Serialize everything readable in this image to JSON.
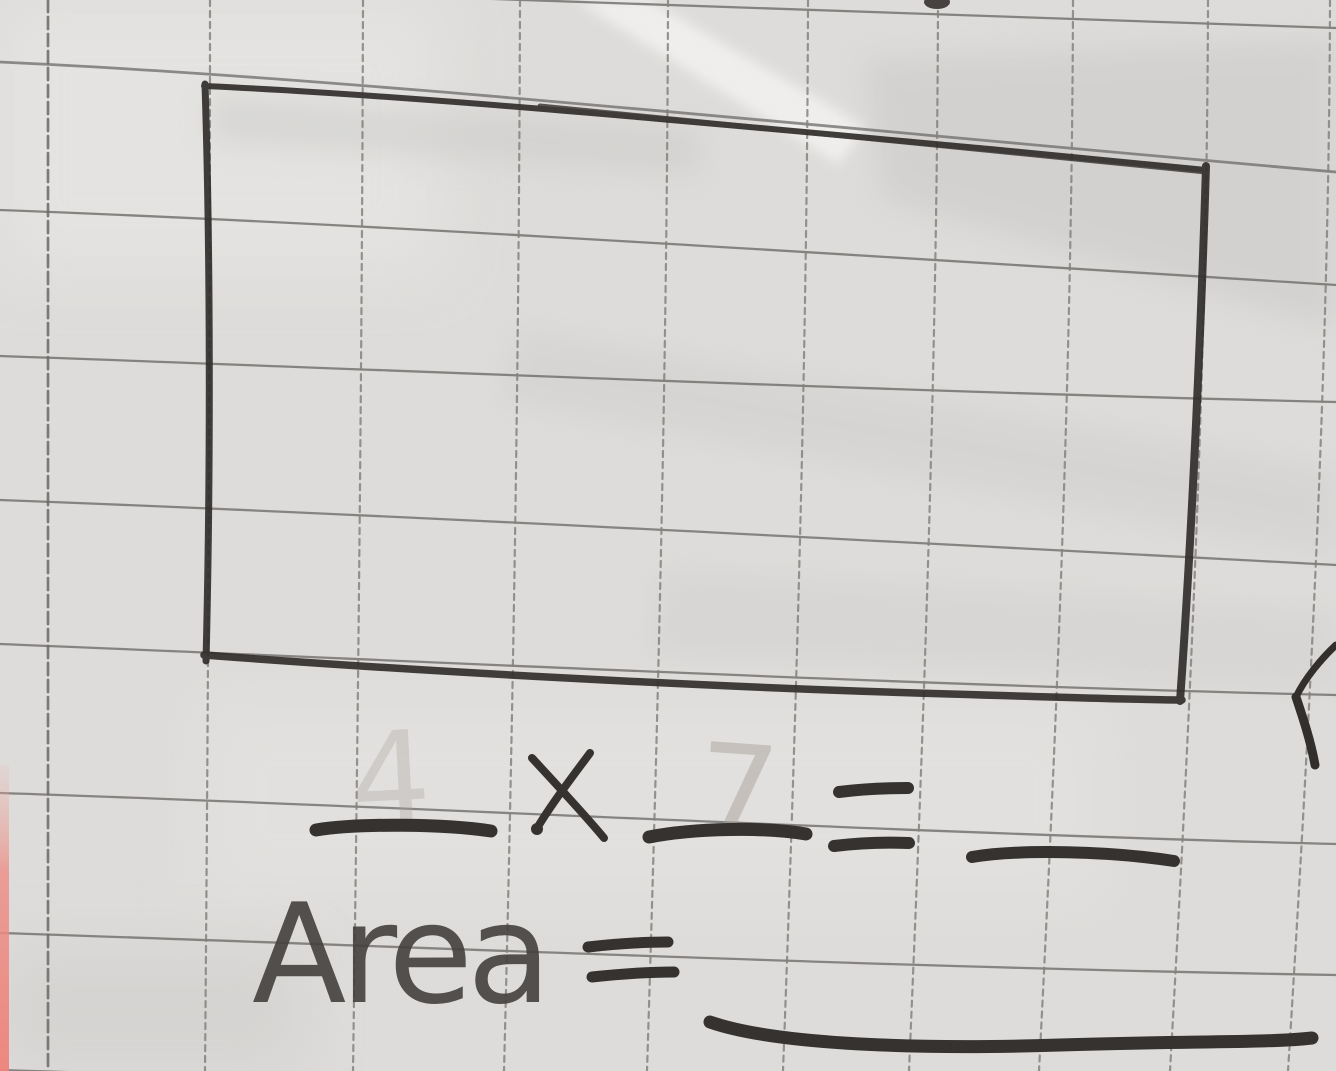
{
  "colors": {
    "paper": "#dedcda",
    "grid_line": "#7a7875",
    "pencil_dark": "#312e2c",
    "pencil_soft": "#44403d",
    "ghost_pencil": "#a9a29b",
    "pink_edge": "#ec8a82"
  },
  "figure": {
    "shape": "rectangle",
    "squares_wide": 7,
    "squares_tall": 4
  },
  "equation": {
    "factor1_blank": "",
    "ghost_factor1": "4",
    "operator": "×",
    "factor2_blank": "",
    "ghost_factor2": "7",
    "equals": "=",
    "result_blank": ""
  },
  "area": {
    "label": "Area",
    "equals": "=",
    "result_blank": ""
  }
}
